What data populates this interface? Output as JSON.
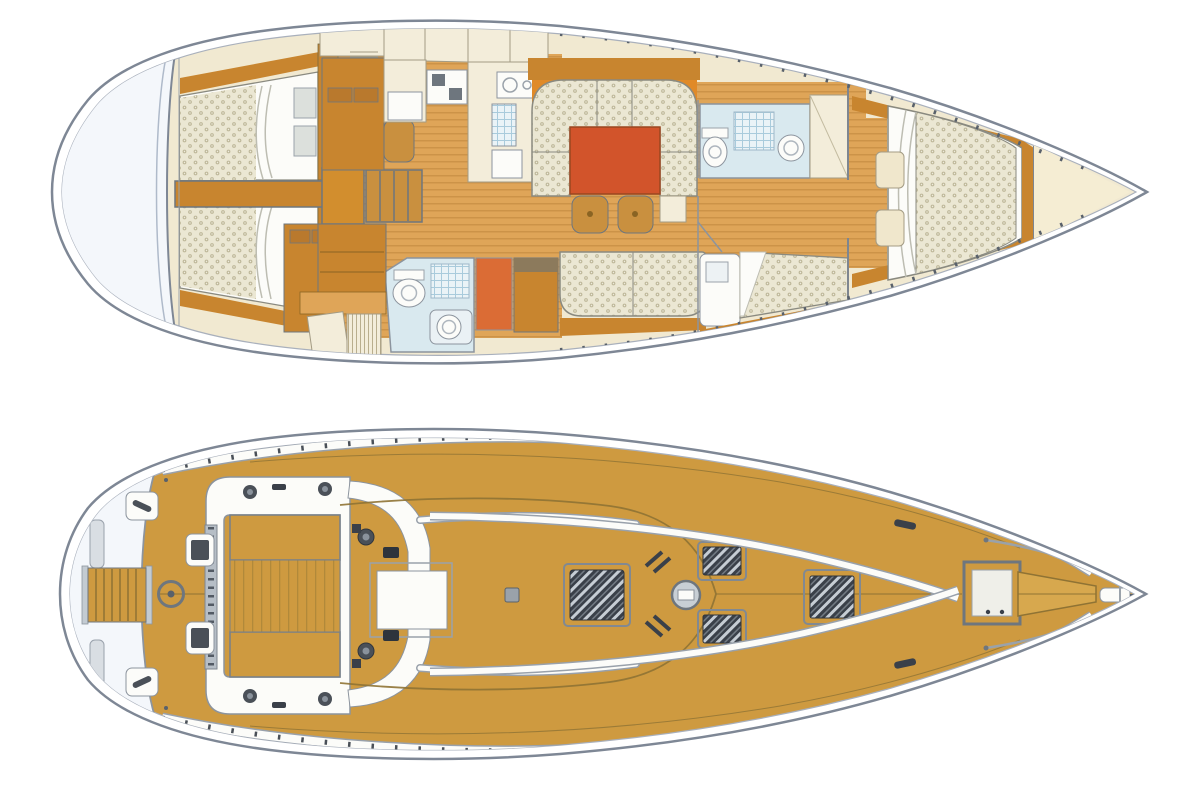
{
  "diagram": {
    "type": "sailing-yacht-layout",
    "views": [
      {
        "id": "interior-plan",
        "regions": [
          "transom-platform",
          "aft-cabin-port",
          "aft-cabin-starboard",
          "companionway",
          "nav-station",
          "galley",
          "salon-dinette",
          "salon-settee",
          "aft-head",
          "forward-head",
          "forward-cabin",
          "master-cabin",
          "forepeak"
        ]
      },
      {
        "id": "deck-plan",
        "regions": [
          "swim-platform",
          "transom",
          "cockpit",
          "helm-station",
          "traveler",
          "companionway-hatch",
          "coachroof",
          "deck-hatches",
          "mast",
          "side-decks",
          "foredeck",
          "anchor-locker",
          "bow-pulpit"
        ]
      }
    ]
  },
  "colors": {
    "bg": "#FFFFFF",
    "hull_stroke": "#7E8795",
    "hull_inner": "#A9B0BC",
    "liner": "#F1E9D1",
    "cream": "#F3EDDA",
    "cream_line": "#8A8578",
    "wood": "#C8852F",
    "wood2": "#C9903F",
    "drawer": "#B9792D",
    "landing": "#D28E2E",
    "floor": "#DFA558",
    "floor_stripe": "#CC9348",
    "mattress": "#EBE7D3",
    "mattress_dot": "#BFB99B",
    "white": "#FCFCF9",
    "table": "#D2542B",
    "locker": "#DB6C35",
    "wedge": "#E08A28",
    "aqua": "#D9E9EF",
    "aqua_grid": "#A9CBDC",
    "steel": "#C3CBD2",
    "steel_dark": "#59616B",
    "gray_line": "#8C949E",
    "deck": "#CE9A40",
    "deck_seam": "#8F7334",
    "hatch": "#3A4049",
    "hatch_frame": "#818992",
    "transom": "#F4F7FB",
    "forepeak": "#F5EDD3"
  }
}
